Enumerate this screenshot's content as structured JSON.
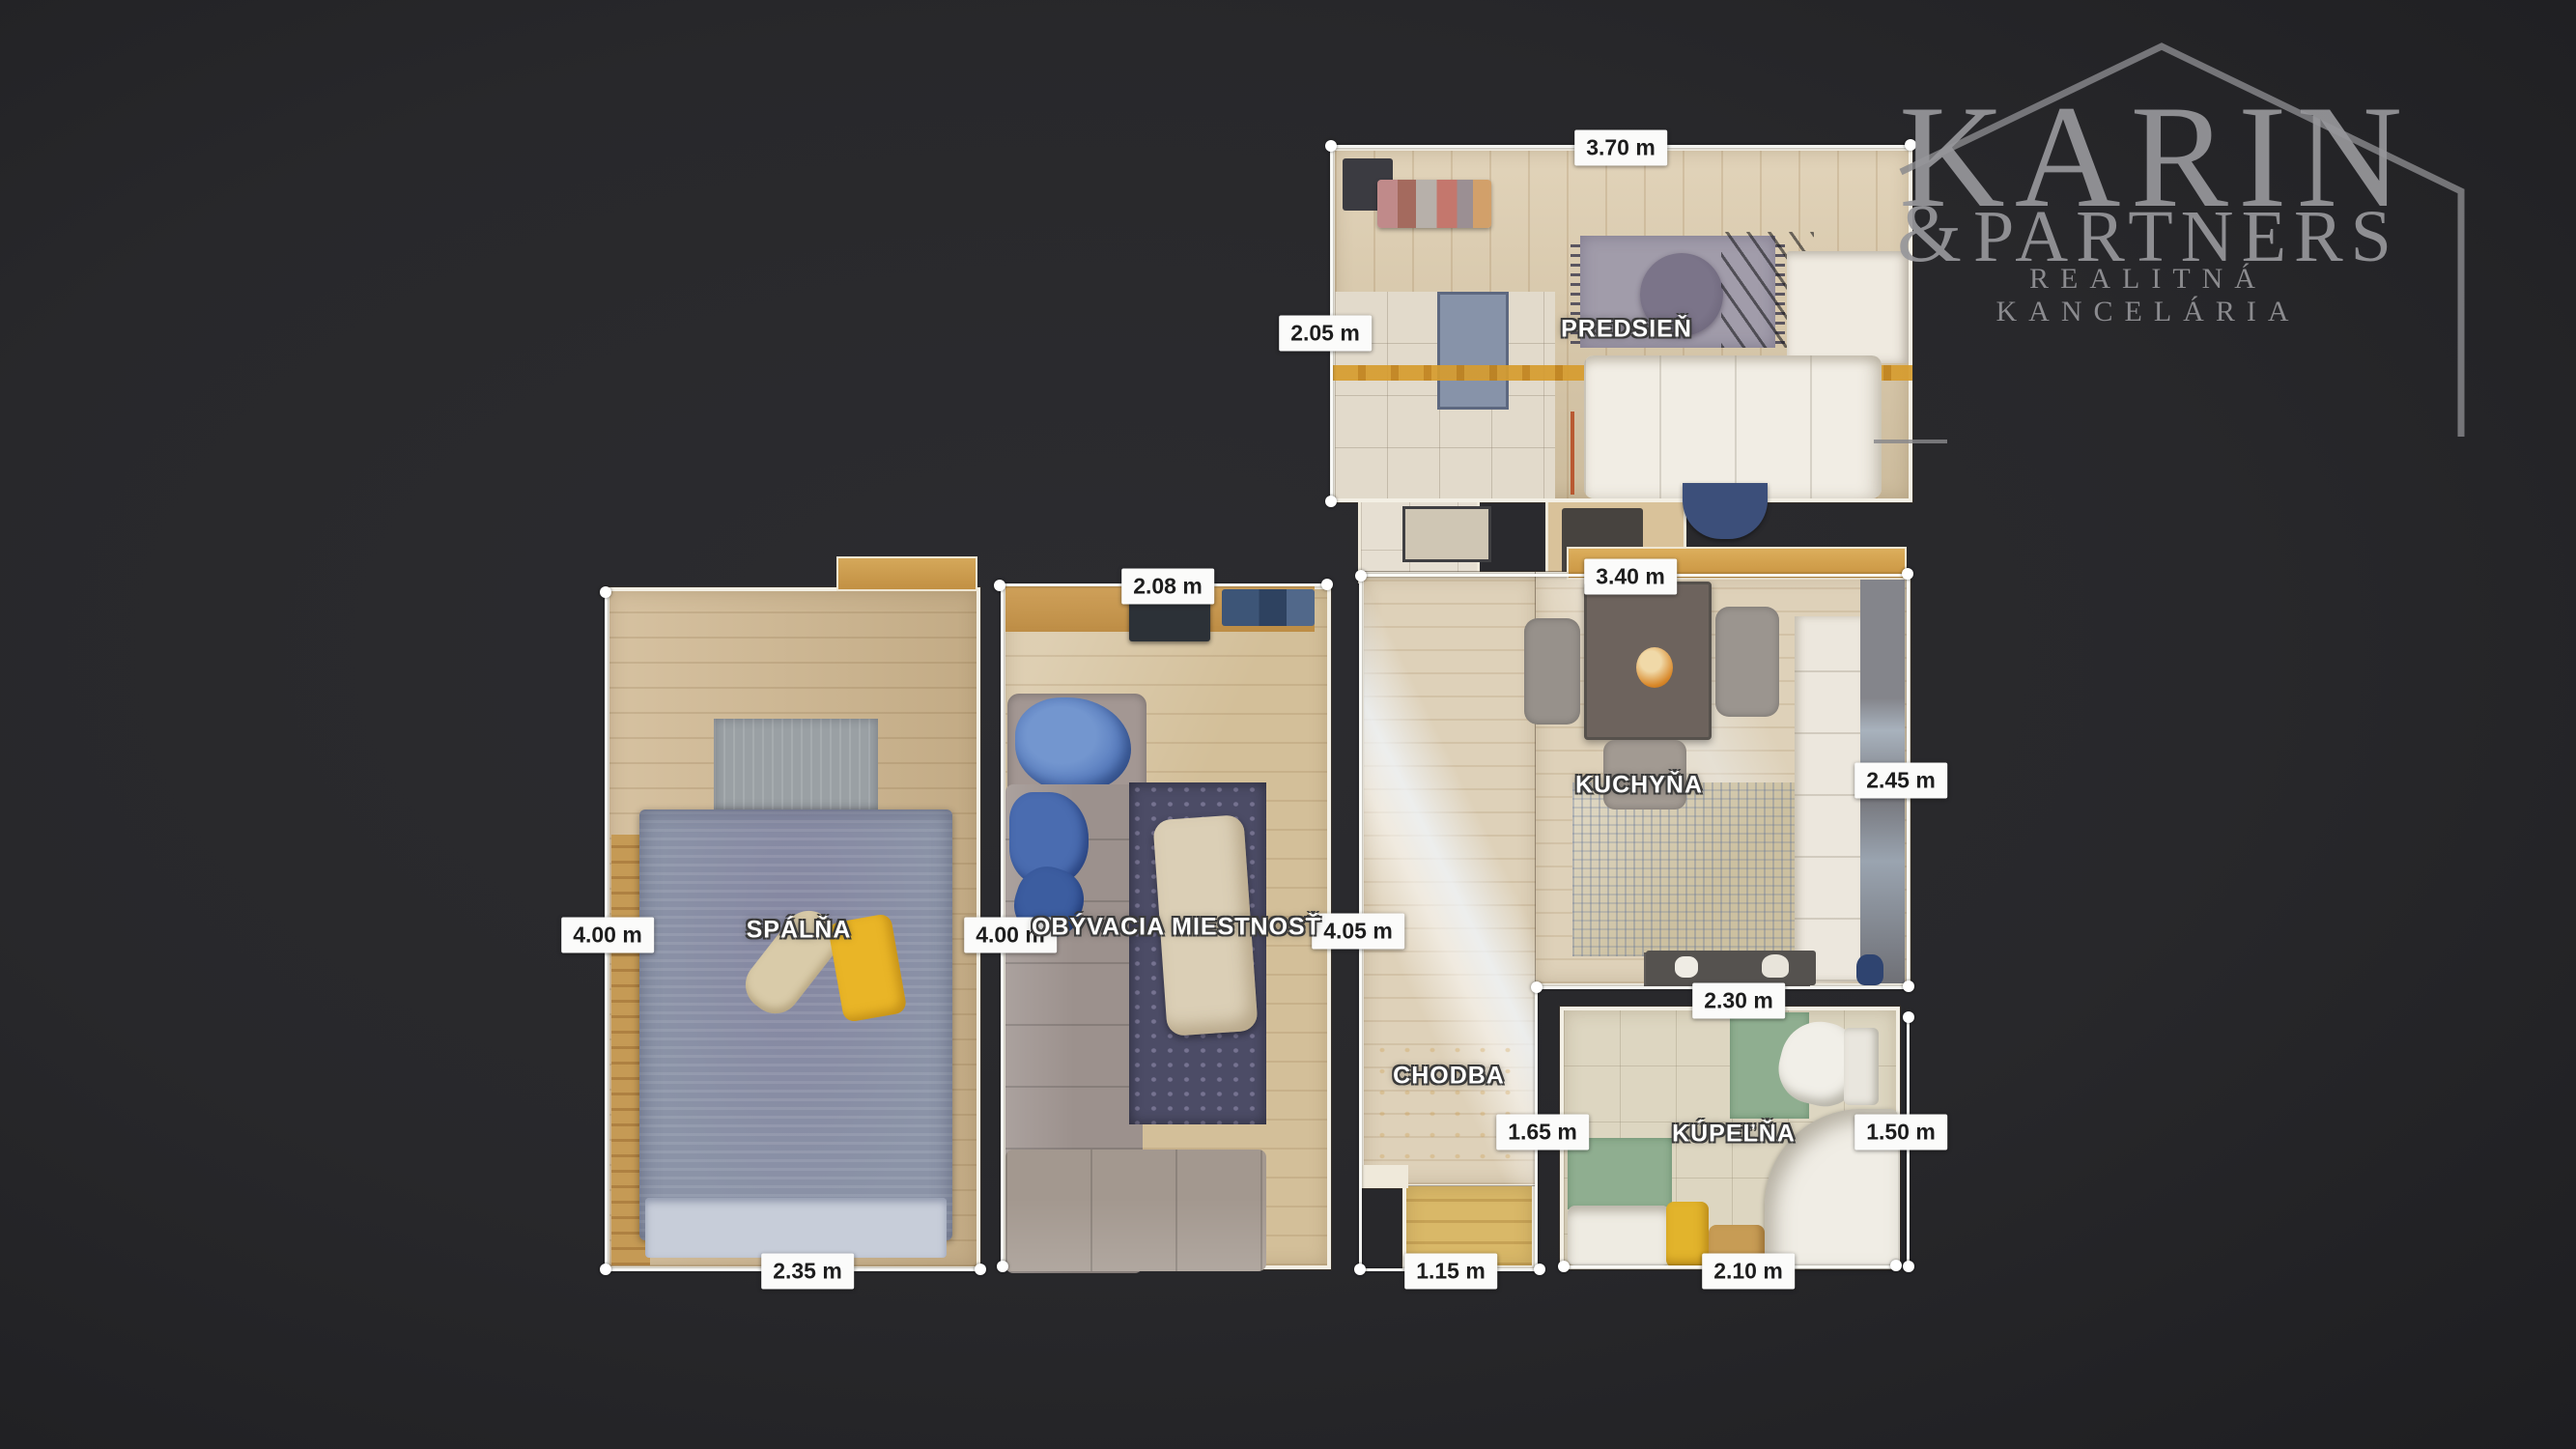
{
  "watermark": {
    "name": "KARIN",
    "amp": "&",
    "partners": "PARTNERS",
    "tagline": "REALITNÁ KANCELÁRIA",
    "color": "#97979b"
  },
  "rooms": {
    "predsien": {
      "name": "PREDSIEŇ",
      "width": "3.70 m",
      "depth": "2.05 m"
    },
    "kuchyna": {
      "name": "KUCHYŇA",
      "width": "3.40 m",
      "depth": "2.45 m",
      "bottom_width": "2.30 m"
    },
    "spalna": {
      "name": "SPÁLŇA",
      "depth": "4.00 m",
      "width": "2.35 m"
    },
    "obyvacia": {
      "name": "OBÝVACIA MIESTNOSŤ",
      "top_width": "2.08 m",
      "depth": "4.00 m"
    },
    "chodba": {
      "name": "CHODBA",
      "depth": "4.05 m",
      "width": "1.15 m"
    },
    "kupelna": {
      "name": "KÚPEĽŇA",
      "left_depth": "1.65 m",
      "right_depth": "1.50 m",
      "width": "2.10 m"
    }
  },
  "colors": {
    "background": "#28282b",
    "measure_chip_bg": "#fbfbfa",
    "measure_chip_text": "#1d1d1d",
    "sun_strip_orange": "#d69c2e",
    "bathroom_mat_green": "#8fae90",
    "bed_blue_gray": "#8b93a7",
    "pillow_yellow": "#e9b527"
  }
}
